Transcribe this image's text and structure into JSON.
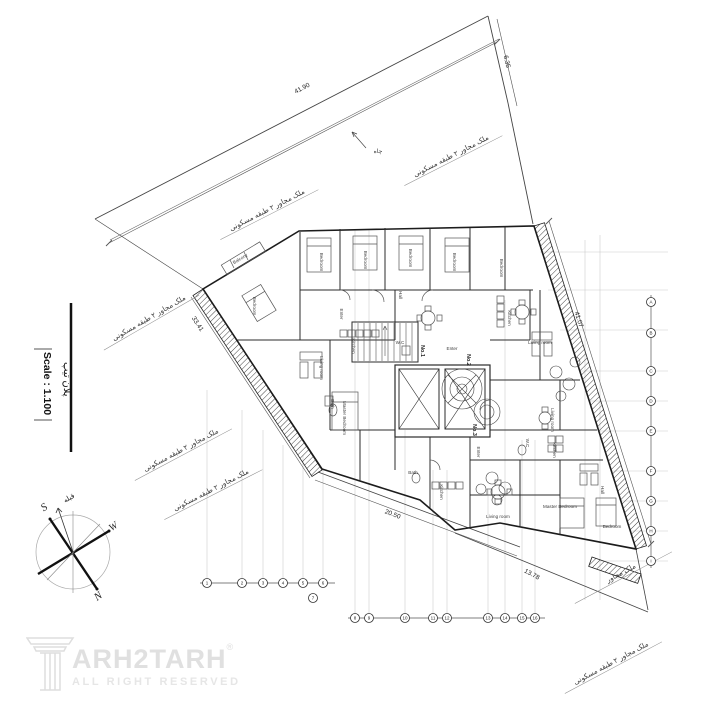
{
  "meta": {
    "background": "#ffffff",
    "ink": "#222222",
    "boundary_gray": "#555555",
    "grid_gray": "#c9c9c9",
    "furniture_gray": "#555555",
    "hatch_color": "#444444",
    "logo_gray": "#e0e0e0"
  },
  "title_block": {
    "plan_label": "پلان تیپ",
    "scale_label": "Scale : 1.100"
  },
  "logo": {
    "brand": "TARH2TARH",
    "brand_after_icon": "ARH2TARH",
    "registered": "®",
    "tagline": "ALL RIGHT RESERVED"
  },
  "compass": {
    "points": [
      {
        "text": "S",
        "x": 46,
        "y": 510,
        "rot": -35,
        "s": 11,
        "f": "serif",
        "i": 1
      },
      {
        "text": "N",
        "x": 100,
        "y": 599,
        "rot": -35,
        "s": 11,
        "f": "serif",
        "i": 1
      },
      {
        "text": "W",
        "x": 115,
        "y": 529,
        "rot": -35,
        "s": 10,
        "f": "serif",
        "i": 1
      },
      {
        "text": "قبله",
        "x": 70,
        "y": 500,
        "rot": -30,
        "s": 7
      }
    ]
  },
  "plan": {
    "dimensions": [
      {
        "text": "41.90",
        "x": 303,
        "y": 90,
        "rot": -27.5
      },
      {
        "text": "6.35",
        "x": 505,
        "y": 62,
        "rot": 77
      },
      {
        "text": "33.41",
        "x": 196,
        "y": 325,
        "rot": 57
      },
      {
        "text": "41.07",
        "x": 577,
        "y": 320,
        "rot": 72.5
      },
      {
        "text": "20.50",
        "x": 392,
        "y": 516,
        "rot": 20.5
      },
      {
        "text": "13.78",
        "x": 531,
        "y": 576,
        "rot": 28
      }
    ],
    "boundary_notes": [
      {
        "text": "ملک مجاور ۲ طبقه مسکونی",
        "x": 452,
        "y": 158,
        "rot": -27
      },
      {
        "text": "ملک مجاور ۲ طبقه مسکونی",
        "x": 268,
        "y": 212,
        "rot": -27
      },
      {
        "text": "ملک مجاور ۲ طبقه مسکونی",
        "x": 150,
        "y": 320,
        "rot": -30
      },
      {
        "text": "ملک مجاور ۲ طبقه مسکونی",
        "x": 182,
        "y": 452,
        "rot": -28
      },
      {
        "text": "ملک مجاور ۲ طبقه مسکونی",
        "x": 212,
        "y": 492,
        "rot": -27
      },
      {
        "text": "ملک مجاور",
        "x": 622,
        "y": 575,
        "rot": -28
      },
      {
        "text": "ملک مجاور ۲ طبقه مسکونی",
        "x": 612,
        "y": 665,
        "rot": -28
      }
    ],
    "site_notes": [
      {
        "text": "چاه",
        "x": 378,
        "y": 153,
        "rot": 0
      }
    ],
    "units": [
      {
        "text": "No.1",
        "x": 421,
        "y": 351,
        "rot": 90
      },
      {
        "text": "No.2",
        "x": 467,
        "y": 360,
        "rot": 90
      },
      {
        "text": "No.3",
        "x": 473,
        "y": 430,
        "rot": 90
      }
    ],
    "rooms": [
      {
        "text": "Bedroom",
        "x": 320,
        "y": 262,
        "rot": 90
      },
      {
        "text": "Bedroom",
        "x": 364,
        "y": 260,
        "rot": 90
      },
      {
        "text": "Bedroom",
        "x": 409,
        "y": 258,
        "rot": 90
      },
      {
        "text": "Bedroom",
        "x": 453,
        "y": 262,
        "rot": 90
      },
      {
        "text": "Bedroom",
        "x": 500,
        "y": 268,
        "rot": 90
      },
      {
        "text": "Bedroom",
        "x": 253,
        "y": 306,
        "rot": 90
      },
      {
        "text": "Bedroom",
        "x": 612,
        "y": 528,
        "rot": 0
      },
      {
        "text": "Master Bedroom",
        "x": 343,
        "y": 418,
        "rot": 90
      },
      {
        "text": "Master Bedroom",
        "x": 560,
        "y": 508,
        "rot": 0
      },
      {
        "text": "Kitchen",
        "x": 352,
        "y": 346,
        "rot": 90
      },
      {
        "text": "Kitchen",
        "x": 508,
        "y": 318,
        "rot": 90
      },
      {
        "text": "Kitchen",
        "x": 440,
        "y": 492,
        "rot": 90
      },
      {
        "text": "Kitchen",
        "x": 553,
        "y": 450,
        "rot": 90
      },
      {
        "text": "Living room",
        "x": 320,
        "y": 368,
        "rot": 90
      },
      {
        "text": "Living room",
        "x": 540,
        "y": 344,
        "rot": 0
      },
      {
        "text": "Living room",
        "x": 551,
        "y": 420,
        "rot": 90
      },
      {
        "text": "Living room",
        "x": 498,
        "y": 518,
        "rot": 0
      },
      {
        "text": "Hall",
        "x": 399,
        "y": 295,
        "rot": 90
      },
      {
        "text": "Hall",
        "x": 601,
        "y": 490,
        "rot": 90
      },
      {
        "text": "Enter",
        "x": 340,
        "y": 314,
        "rot": 90
      },
      {
        "text": "Enter",
        "x": 452,
        "y": 350,
        "rot": 0
      },
      {
        "text": "Enter",
        "x": 477,
        "y": 452,
        "rot": 90
      },
      {
        "text": "Bath",
        "x": 331,
        "y": 404,
        "rot": 90
      },
      {
        "text": "Bath",
        "x": 413,
        "y": 474,
        "rot": 0
      },
      {
        "text": "W.C",
        "x": 400,
        "y": 344,
        "rot": 0
      },
      {
        "text": "W.C",
        "x": 526,
        "y": 443,
        "rot": 90
      },
      {
        "text": "Balcony",
        "x": 241,
        "y": 260,
        "rot": -31
      }
    ],
    "grid": {
      "bottom_bubbles": [
        {
          "label": "1",
          "x": 207,
          "y": 583
        },
        {
          "label": "2",
          "x": 242,
          "y": 583
        },
        {
          "label": "3",
          "x": 263,
          "y": 583
        },
        {
          "label": "4",
          "x": 283,
          "y": 583
        },
        {
          "label": "5",
          "x": 303,
          "y": 583
        },
        {
          "label": "6",
          "x": 323,
          "y": 583
        },
        {
          "label": "7",
          "x": 313,
          "y": 598
        },
        {
          "label": "8",
          "x": 355,
          "y": 618
        },
        {
          "label": "9",
          "x": 369,
          "y": 618
        },
        {
          "label": "10",
          "x": 405,
          "y": 618
        },
        {
          "label": "11",
          "x": 433,
          "y": 618
        },
        {
          "label": "12",
          "x": 447,
          "y": 618
        },
        {
          "label": "13",
          "x": 488,
          "y": 618
        },
        {
          "label": "14",
          "x": 505,
          "y": 618
        },
        {
          "label": "15",
          "x": 522,
          "y": 618
        },
        {
          "label": "16",
          "x": 535,
          "y": 618
        }
      ],
      "right_bubbles": [
        {
          "label": "A",
          "x": 651,
          "y": 302
        },
        {
          "label": "B",
          "x": 651,
          "y": 333
        },
        {
          "label": "C",
          "x": 651,
          "y": 371
        },
        {
          "label": "D",
          "x": 651,
          "y": 401
        },
        {
          "label": "E",
          "x": 651,
          "y": 431
        },
        {
          "label": "F",
          "x": 651,
          "y": 471
        },
        {
          "label": "G",
          "x": 651,
          "y": 501
        },
        {
          "label": "H",
          "x": 651,
          "y": 531
        },
        {
          "label": "I",
          "x": 651,
          "y": 561
        }
      ]
    }
  }
}
